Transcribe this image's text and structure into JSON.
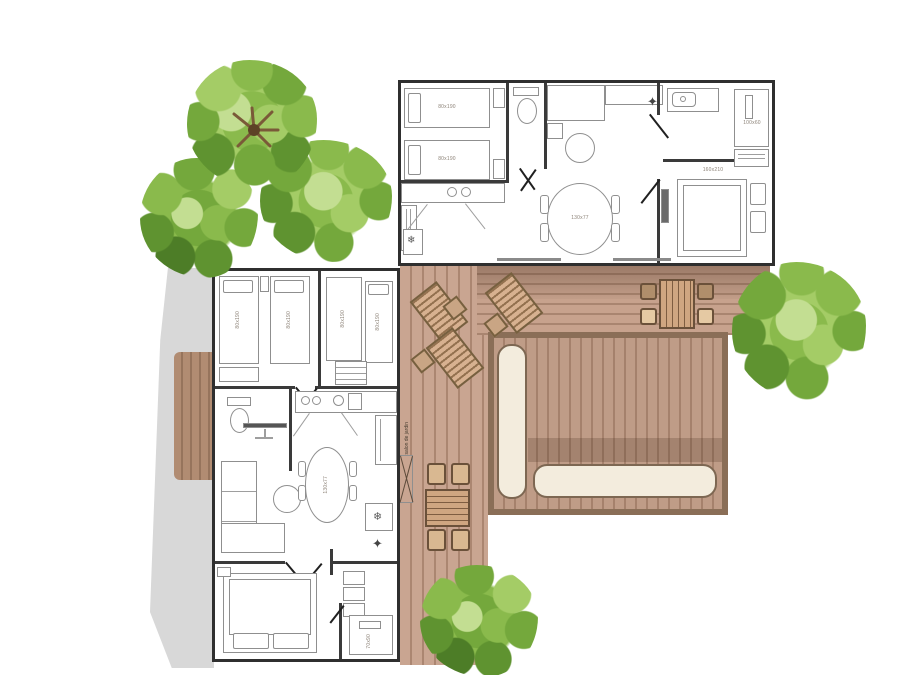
{
  "plan": {
    "top_unit": {
      "bed_left_1": "80x190",
      "bed_left_2": "80x190",
      "dining_table": "130x77",
      "wardrobe": "100x60",
      "master_room": "160x210",
      "master_bed": "140x190"
    },
    "bottom_unit": {
      "bed_1": "80x190",
      "bed_2": "80x190",
      "bed_3": "80x190",
      "bed_4": "80x190",
      "dining_table": "130x77",
      "master_bed": "140x190",
      "shower": "70x90"
    },
    "terrace": {
      "note": "salon de jardin"
    },
    "icons": {
      "fridge": "❄",
      "light": "✦"
    },
    "colors": {
      "deck_plank": "#c7a28d",
      "deck_gap": "#a98570",
      "lounge_frame": "#8a6e57",
      "cushion": "#f3ecdd",
      "tree_green": "#8aba4c",
      "wall": "#3a3a3a",
      "shadow": "#d8d8d8"
    }
  }
}
